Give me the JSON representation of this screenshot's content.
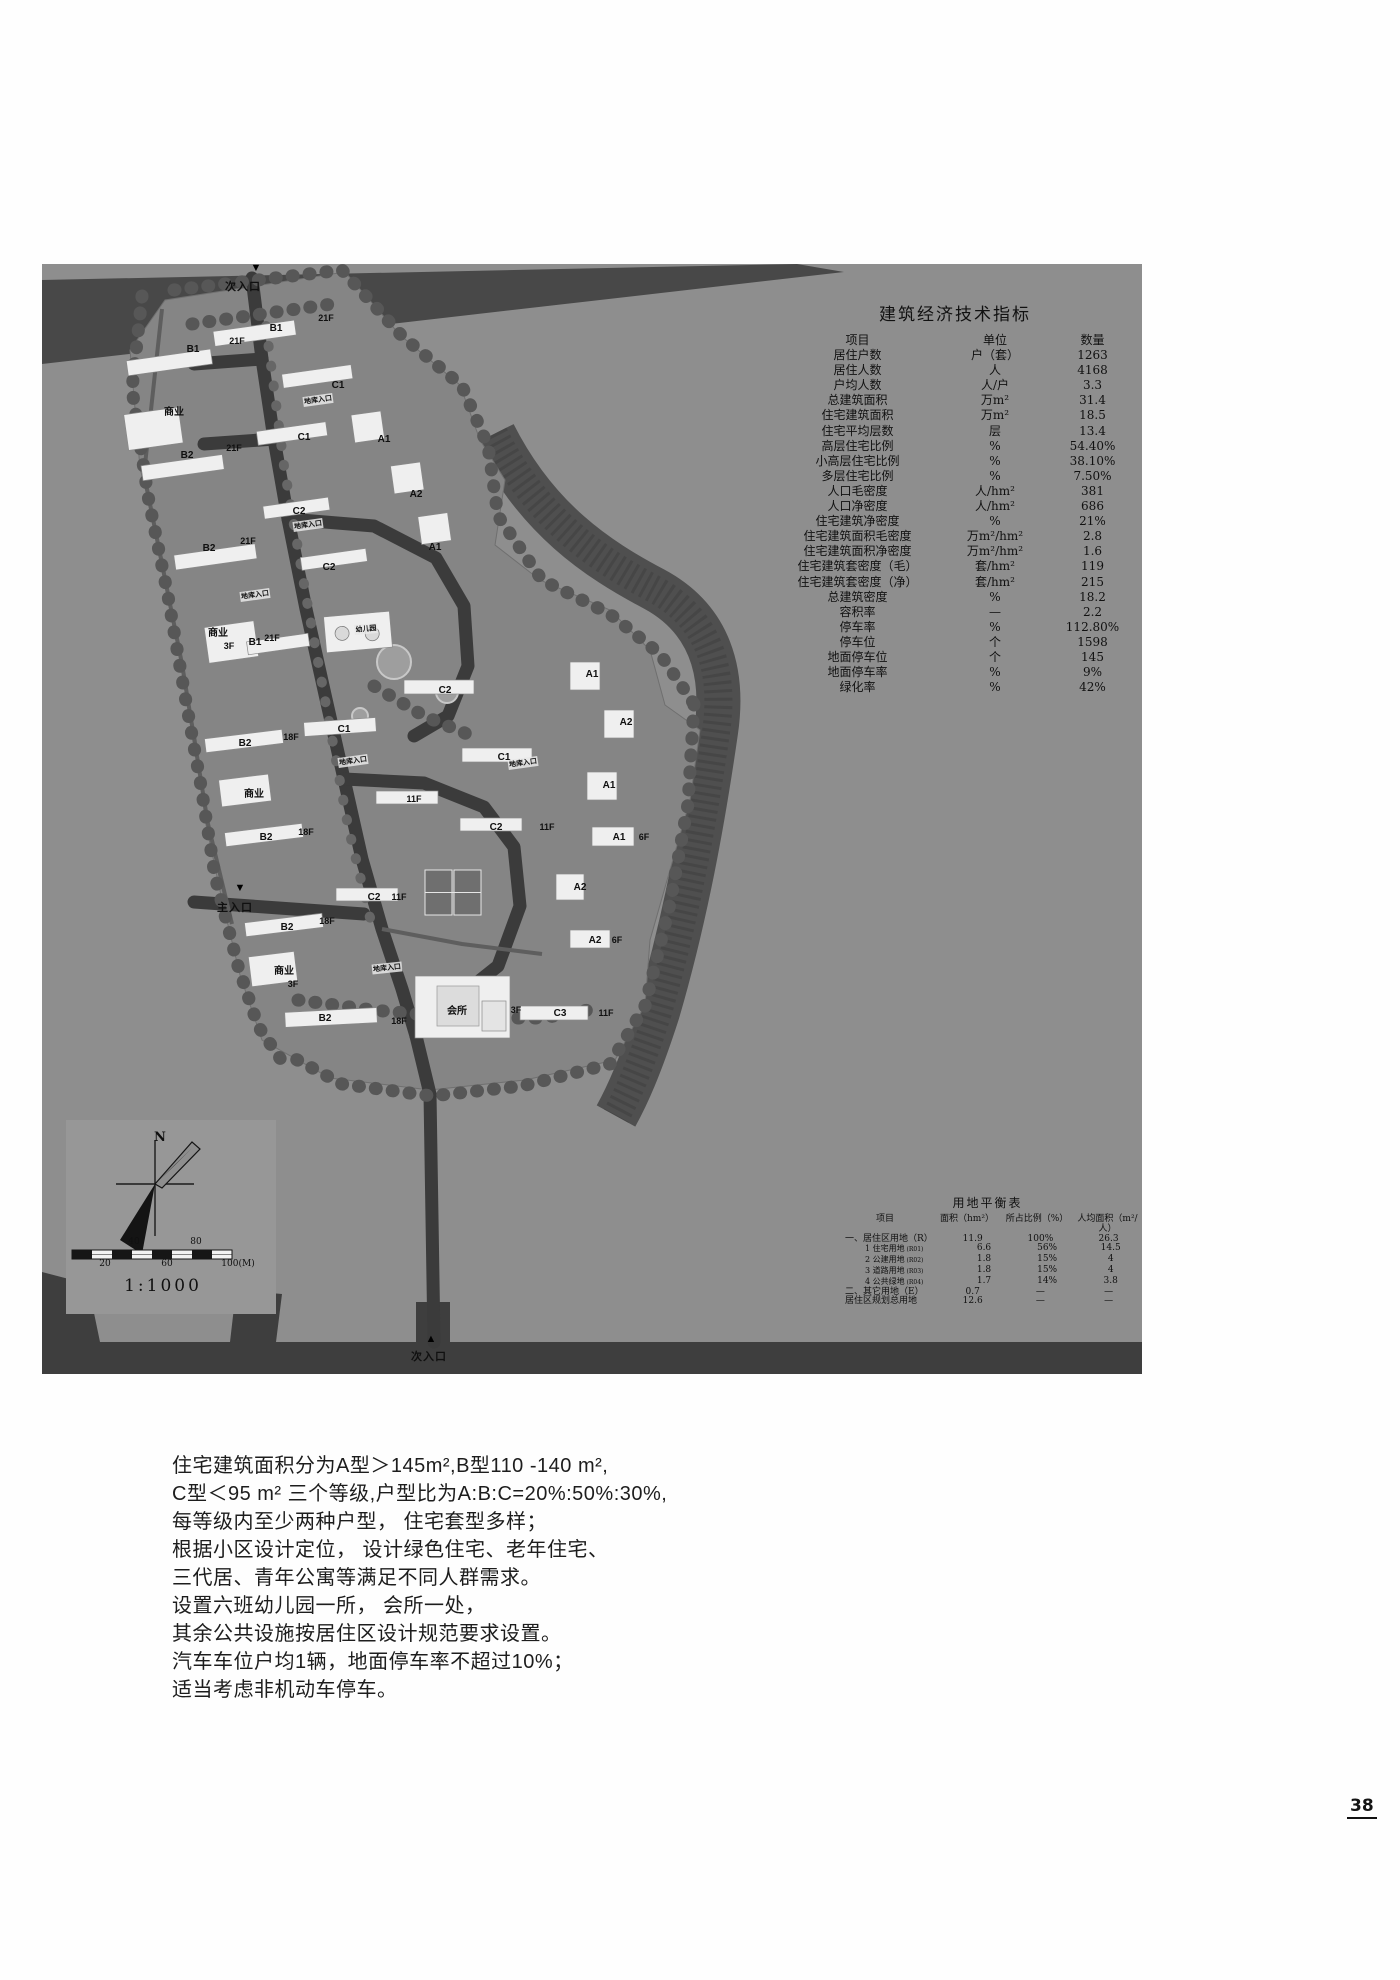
{
  "colors": {
    "plan_bg": "#8e8e8e",
    "road": "#3e3e3e",
    "community": "#858585",
    "building": "#efefef",
    "text": "#111111"
  },
  "econ_table": {
    "title": "建筑经济技术指标",
    "headers": [
      "项目",
      "单位",
      "数量"
    ],
    "rows": [
      [
        "居住户数",
        "户（套）",
        "1263"
      ],
      [
        "居住人数",
        "人",
        "4168"
      ],
      [
        "户均人数",
        "人/户",
        "3.3"
      ],
      [
        "总建筑面积",
        "万m²",
        "31.4"
      ],
      [
        "住宅建筑面积",
        "万m²",
        "18.5"
      ],
      [
        "住宅平均层数",
        "层",
        "13.4"
      ],
      [
        "高层住宅比例",
        "%",
        "54.40%"
      ],
      [
        "小高层住宅比例",
        "%",
        "38.10%"
      ],
      [
        "多层住宅比例",
        "%",
        "7.50%"
      ],
      [
        "人口毛密度",
        "人/hm²",
        "381"
      ],
      [
        "人口净密度",
        "人/hm²",
        "686"
      ],
      [
        "住宅建筑净密度",
        "%",
        "21%"
      ],
      [
        "住宅建筑面积毛密度",
        "万m²/hm²",
        "2.8"
      ],
      [
        "住宅建筑面积净密度",
        "万m²/hm²",
        "1.6"
      ],
      [
        "住宅建筑套密度（毛）",
        "套/hm²",
        "119"
      ],
      [
        "住宅建筑套密度（净）",
        "套/hm²",
        "215"
      ],
      [
        "总建筑密度",
        "%",
        "18.2"
      ],
      [
        "容积率",
        "—",
        "2.2"
      ],
      [
        "停车率",
        "%",
        "112.80%"
      ],
      [
        "停车位",
        "个",
        "1598"
      ],
      [
        "地面停车位",
        "个",
        "145"
      ],
      [
        "地面停车率",
        "%",
        "9%"
      ],
      [
        "绿化率",
        "%",
        "42%"
      ]
    ]
  },
  "land_table": {
    "title": "用地平衡表",
    "headers": [
      "项目",
      "面积（hm²）",
      "所占比例（%）",
      "人均面积（m²/人）"
    ],
    "rows": [
      {
        "item": "一、居住区用地（R）",
        "code": "",
        "area": "11.9",
        "ratio": "100%",
        "per": "26.3",
        "indent": 0
      },
      {
        "item": "1 住宅用地",
        "code": "(R01)",
        "area": "6.6",
        "ratio": "56%",
        "per": "14.5",
        "indent": 1
      },
      {
        "item": "2 公建用地",
        "code": "(R02)",
        "area": "1.8",
        "ratio": "15%",
        "per": "4",
        "indent": 1
      },
      {
        "item": "3 道路用地",
        "code": "(R03)",
        "area": "1.8",
        "ratio": "15%",
        "per": "4",
        "indent": 1
      },
      {
        "item": "4 公共绿地",
        "code": "(R04)",
        "area": "1.7",
        "ratio": "14%",
        "per": "3.8",
        "indent": 1
      },
      {
        "item": "二、其它用地（E）",
        "code": "",
        "area": "0.7",
        "ratio": "—",
        "per": "—",
        "indent": 0
      },
      {
        "item": "居住区规划总用地",
        "code": "",
        "area": "12.6",
        "ratio": "—",
        "per": "—",
        "indent": 0
      }
    ]
  },
  "plan": {
    "entrances": [
      {
        "label": "次入口",
        "dir": "down",
        "ax": 256,
        "ay": 262,
        "x": 243,
        "y": 278
      },
      {
        "label": "主入口",
        "dir": "down",
        "ax": 240,
        "ay": 882,
        "x": 235,
        "y": 899
      },
      {
        "label": "次入口",
        "dir": "up",
        "ax": 431,
        "ay": 1333,
        "x": 429,
        "y": 1348
      }
    ],
    "labels": [
      {
        "t": "B1",
        "x": 193,
        "y": 344,
        "c": "md"
      },
      {
        "t": "21F",
        "x": 237,
        "y": 336,
        "c": "sm"
      },
      {
        "t": "B1",
        "x": 276,
        "y": 323,
        "c": "md"
      },
      {
        "t": "21F",
        "x": 326,
        "y": 313,
        "c": "sm"
      },
      {
        "t": "商业",
        "x": 174,
        "y": 403,
        "c": "md"
      },
      {
        "t": "C1",
        "x": 338,
        "y": 380,
        "c": "md"
      },
      {
        "t": "地库入口",
        "x": 318,
        "y": 395,
        "c": "xs",
        "r": -8
      },
      {
        "t": "C1",
        "x": 304,
        "y": 432,
        "c": "md"
      },
      {
        "t": "A1",
        "x": 384,
        "y": 434,
        "c": "md"
      },
      {
        "t": "B2",
        "x": 187,
        "y": 450,
        "c": "md"
      },
      {
        "t": "21F",
        "x": 234,
        "y": 443,
        "c": "sm"
      },
      {
        "t": "C2",
        "x": 299,
        "y": 506,
        "c": "md"
      },
      {
        "t": "A2",
        "x": 416,
        "y": 489,
        "c": "md"
      },
      {
        "t": "B2",
        "x": 209,
        "y": 543,
        "c": "md"
      },
      {
        "t": "21F",
        "x": 248,
        "y": 536,
        "c": "sm"
      },
      {
        "t": "地库入口",
        "x": 308,
        "y": 520,
        "c": "xs",
        "r": -8
      },
      {
        "t": "C2",
        "x": 329,
        "y": 562,
        "c": "md"
      },
      {
        "t": "A1",
        "x": 435,
        "y": 542,
        "c": "md"
      },
      {
        "t": "地库入口",
        "x": 255,
        "y": 590,
        "c": "xs",
        "r": -8
      },
      {
        "t": "商业",
        "x": 218,
        "y": 624,
        "c": "md"
      },
      {
        "t": "3F",
        "x": 229,
        "y": 641,
        "c": "sm"
      },
      {
        "t": "B1",
        "x": 255,
        "y": 637,
        "c": "md"
      },
      {
        "t": "21F",
        "x": 272,
        "y": 633,
        "c": "sm"
      },
      {
        "t": "幼儿园",
        "x": 366,
        "y": 624,
        "c": "xs",
        "r": -5
      },
      {
        "t": "A1",
        "x": 592,
        "y": 669,
        "c": "md"
      },
      {
        "t": "C2",
        "x": 445,
        "y": 685,
        "c": "md"
      },
      {
        "t": "A2",
        "x": 626,
        "y": 717,
        "c": "md"
      },
      {
        "t": "C1",
        "x": 344,
        "y": 724,
        "c": "md"
      },
      {
        "t": "B2",
        "x": 245,
        "y": 738,
        "c": "md"
      },
      {
        "t": "18F",
        "x": 291,
        "y": 732,
        "c": "sm"
      },
      {
        "t": "地库入口",
        "x": 353,
        "y": 756,
        "c": "xs",
        "r": -8
      },
      {
        "t": "C1",
        "x": 504,
        "y": 752,
        "c": "md"
      },
      {
        "t": "地库入口",
        "x": 523,
        "y": 758,
        "c": "xs",
        "r": -8
      },
      {
        "t": "商业",
        "x": 254,
        "y": 785,
        "c": "md"
      },
      {
        "t": "A1",
        "x": 609,
        "y": 780,
        "c": "md"
      },
      {
        "t": "11F",
        "x": 414,
        "y": 794,
        "c": "sm"
      },
      {
        "t": "C2",
        "x": 496,
        "y": 822,
        "c": "md"
      },
      {
        "t": "11F",
        "x": 547,
        "y": 822,
        "c": "sm"
      },
      {
        "t": "A1",
        "x": 619,
        "y": 832,
        "c": "md"
      },
      {
        "t": "6F",
        "x": 644,
        "y": 832,
        "c": "sm"
      },
      {
        "t": "B2",
        "x": 266,
        "y": 832,
        "c": "md"
      },
      {
        "t": "18F",
        "x": 306,
        "y": 827,
        "c": "sm"
      },
      {
        "t": "C2",
        "x": 374,
        "y": 892,
        "c": "md"
      },
      {
        "t": "11F",
        "x": 399,
        "y": 892,
        "c": "sm"
      },
      {
        "t": "A2",
        "x": 580,
        "y": 882,
        "c": "md"
      },
      {
        "t": "B2",
        "x": 287,
        "y": 922,
        "c": "md"
      },
      {
        "t": "18F",
        "x": 327,
        "y": 916,
        "c": "sm"
      },
      {
        "t": "A2",
        "x": 595,
        "y": 935,
        "c": "md"
      },
      {
        "t": "6F",
        "x": 617,
        "y": 935,
        "c": "sm"
      },
      {
        "t": "地库入口",
        "x": 387,
        "y": 963,
        "c": "xs",
        "r": -6
      },
      {
        "t": "商业",
        "x": 284,
        "y": 962,
        "c": "md"
      },
      {
        "t": "3F",
        "x": 293,
        "y": 979,
        "c": "sm"
      },
      {
        "t": "会所",
        "x": 457,
        "y": 1002,
        "c": "md"
      },
      {
        "t": "3F",
        "x": 516,
        "y": 1005,
        "c": "sm"
      },
      {
        "t": "C3",
        "x": 560,
        "y": 1008,
        "c": "md"
      },
      {
        "t": "11F",
        "x": 606,
        "y": 1008,
        "c": "sm"
      },
      {
        "t": "B2",
        "x": 325,
        "y": 1013,
        "c": "md"
      },
      {
        "t": "18F",
        "x": 399,
        "y": 1016,
        "c": "sm"
      },
      {
        "t": "N",
        "x": 160,
        "y": 1130,
        "c": "north"
      },
      {
        "t": "40",
        "x": 134,
        "y": 1237,
        "c": "tick"
      },
      {
        "t": "80",
        "x": 196,
        "y": 1237,
        "c": "tick"
      },
      {
        "t": "20",
        "x": 105,
        "y": 1259,
        "c": "tick"
      },
      {
        "t": "60",
        "x": 167,
        "y": 1259,
        "c": "tick"
      },
      {
        "t": "100(M)",
        "x": 238,
        "y": 1259,
        "c": "tick"
      },
      {
        "t": "1:1000",
        "x": 163,
        "y": 1276,
        "c": "ratio"
      }
    ]
  },
  "notes": {
    "lines": [
      "住宅建筑面积分为A型＞145m²,B型110 -140 m²,",
      "C型＜95 m² 三个等级,户型比为A:B:C=20%:50%:30%,",
      "每等级内至少两种户型， 住宅套型多样；",
      "根据小区设计定位， 设计绿色住宅、老年住宅、",
      "三代居、青年公寓等满足不同人群需求。",
      "设置六班幼儿园一所， 会所一处，",
      "其余公共设施按居住区设计规范要求设置。",
      "汽车车位户均1辆，地面停车率不超过10%；",
      "适当考虑非机动车停车。"
    ]
  },
  "page": {
    "number": "38"
  }
}
